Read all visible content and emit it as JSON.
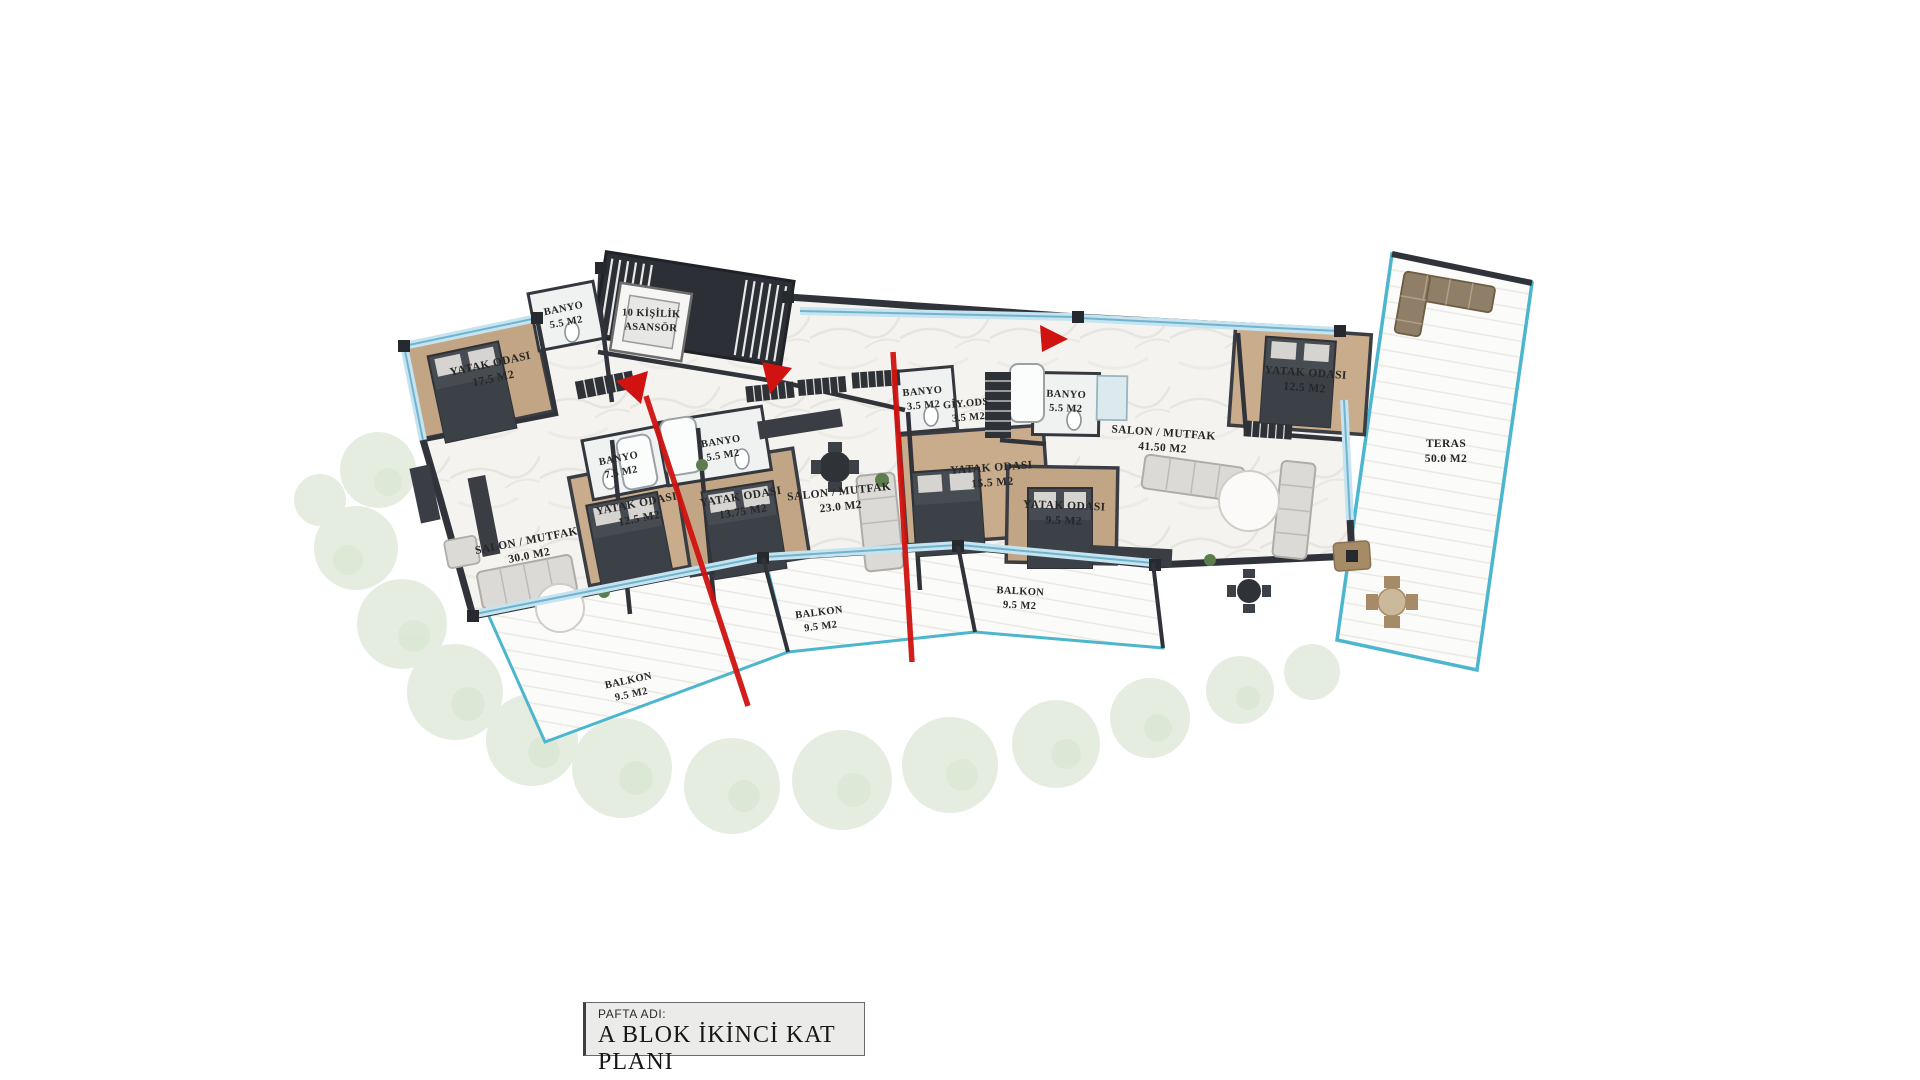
{
  "title_block": {
    "label": "PAFTA ADI:",
    "title": "A BLOK İKİNCİ KAT PLANI"
  },
  "rooms": {
    "yatak_tl": {
      "name": "YATAK ODASI",
      "area": "17.5 M2"
    },
    "banyo_top": {
      "name": "BANYO",
      "area": "5.5 M2"
    },
    "asansor": {
      "name": "10 KİŞİLİK",
      "area": "ASANSÖR"
    },
    "banyo_left": {
      "name": "BANYO",
      "area": "7.5 M2"
    },
    "banyo_mid": {
      "name": "BANYO",
      "area": "5.5 M2"
    },
    "salon_left": {
      "name": "SALON / MUTFAK",
      "area": "30.0 M2"
    },
    "yatak_left": {
      "name": "YATAK ODASI",
      "area": "12.5 M2"
    },
    "yatak_mid": {
      "name": "YATAK ODASI",
      "area": "13.75 M2"
    },
    "salon_mid": {
      "name": "SALON / MUTFAK",
      "area": "23.0 M2"
    },
    "banyo_c1": {
      "name": "BANYO",
      "area": "3.5 M2"
    },
    "giy_ods": {
      "name": "GİY.ODS.",
      "area": "3.5 M2"
    },
    "banyo_c2": {
      "name": "BANYO",
      "area": "5.5 M2"
    },
    "yatak_c1": {
      "name": "YATAK ODASI",
      "area": "15.5 M2"
    },
    "yatak_c2": {
      "name": "YATAK ODASI",
      "area": "9.5 M2"
    },
    "salon_right": {
      "name": "SALON / MUTFAK",
      "area": "41.50 M2"
    },
    "yatak_right": {
      "name": "YATAK ODASI",
      "area": "12.5 M2"
    },
    "teras": {
      "name": "TERAS",
      "area": "50.0 M2"
    },
    "balkon_left": {
      "name": "BALKON",
      "area": "9.5 M2"
    },
    "balkon_mid": {
      "name": "BALKON",
      "area": "9.5 M2"
    },
    "balkon_right": {
      "name": "BALKON",
      "area": "9.5 M2"
    }
  },
  "colors": {
    "wall": "#30343a",
    "bedroom_floor": "#c2a585",
    "marble_floor": "#f4f3f0",
    "glass": "#c6e3f0",
    "balcony_line": "#4db6cf",
    "section_red": "#d01310",
    "foliage": "#e3ecdd"
  }
}
